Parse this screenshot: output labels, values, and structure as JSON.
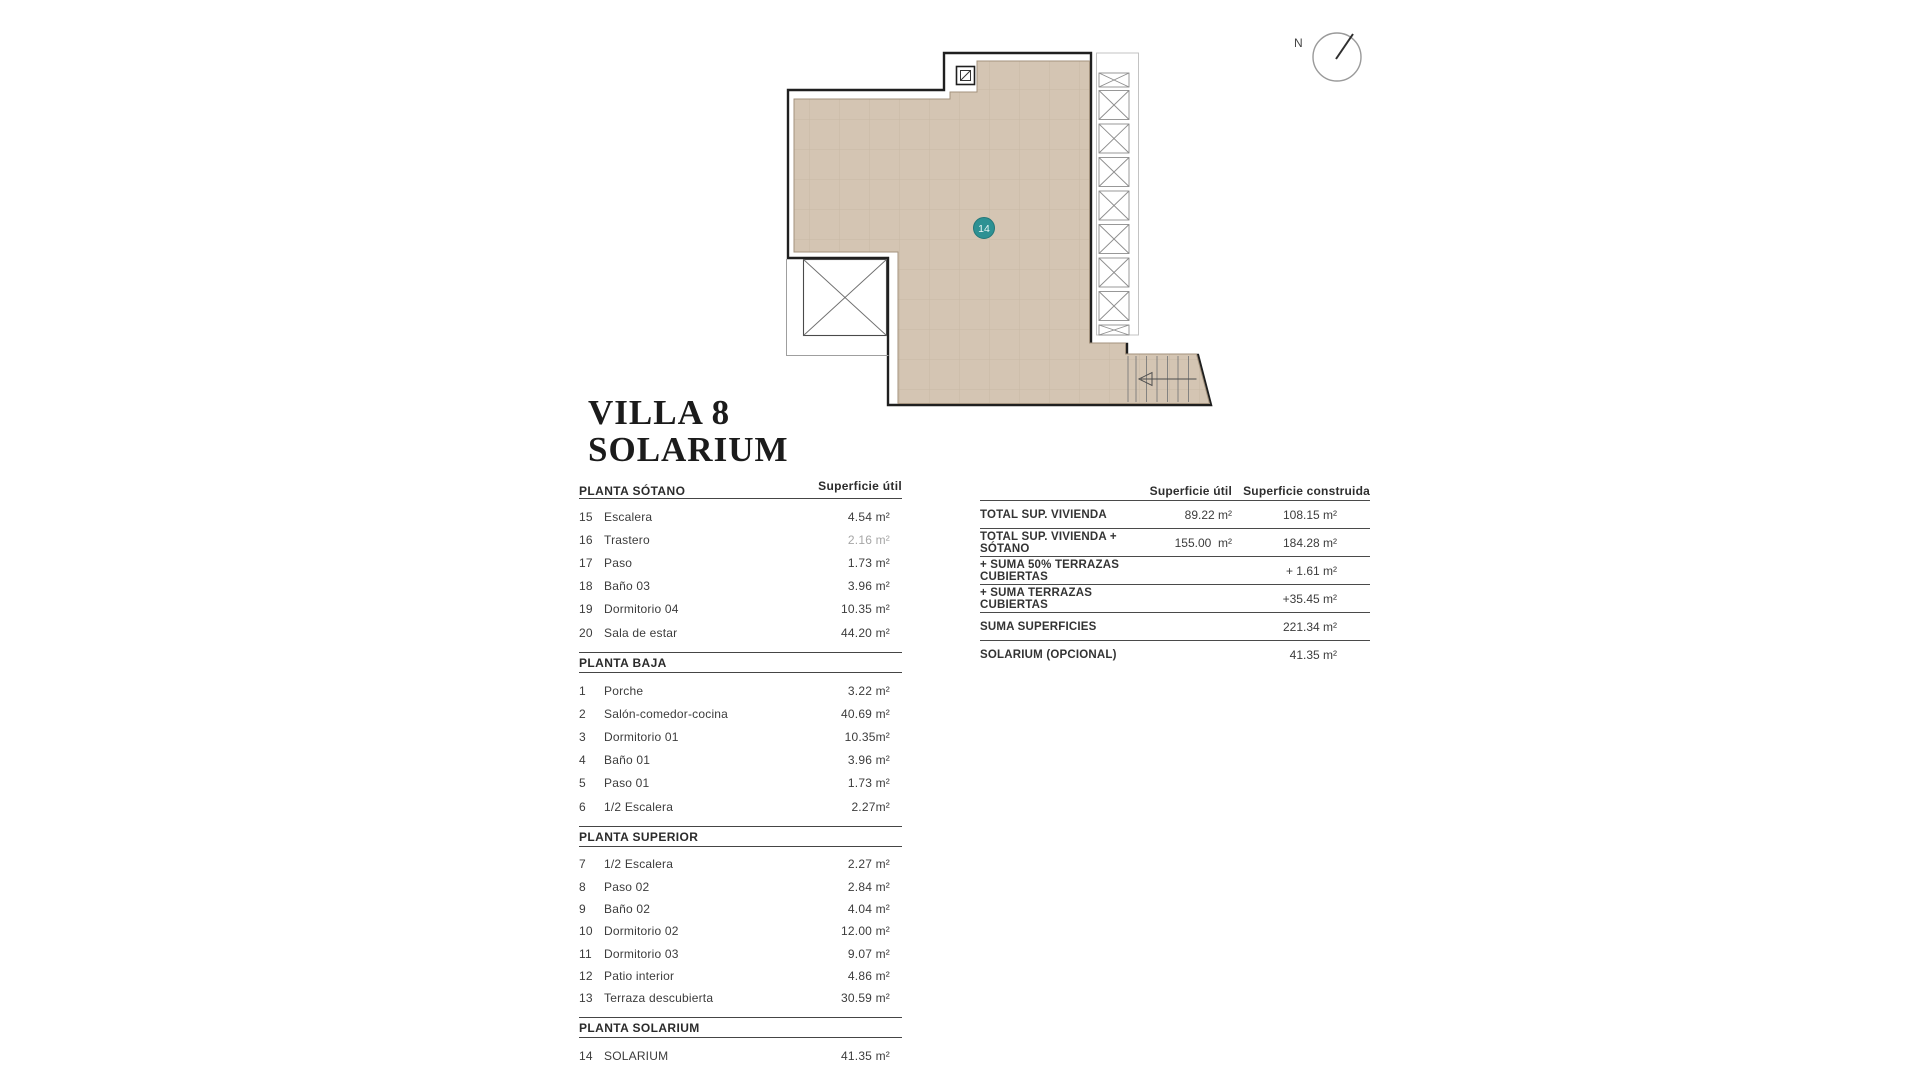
{
  "title": {
    "line1": "VILLA 8",
    "line2": "SOLARIUM"
  },
  "plan": {
    "unit_badge": "14",
    "compass_label": "N"
  },
  "left_table": {
    "area_header": "Superficie útil",
    "sections": [
      {
        "header": "PLANTA SÓTANO",
        "rows": [
          {
            "num": "15",
            "label": "Escalera",
            "value": "4.54 m²"
          },
          {
            "num": "16",
            "label": "Trastero",
            "value": "2.16 m²"
          },
          {
            "num": "17",
            "label": "Paso",
            "value": "1.73 m²"
          },
          {
            "num": "18",
            "label": "Baño 03",
            "value": "3.96 m²"
          },
          {
            "num": "19",
            "label": "Dormitorio 04",
            "value": "10.35 m²"
          },
          {
            "num": "20",
            "label": "Sala de estar",
            "value": "44.20 m²"
          }
        ]
      },
      {
        "header": "PLANTA BAJA",
        "rows": [
          {
            "num": "1",
            "label": "Porche",
            "value": "3.22 m²"
          },
          {
            "num": "2",
            "label": "Salón-comedor-cocina",
            "value": "40.69 m²"
          },
          {
            "num": "3",
            "label": "Dormitorio 01",
            "value": "10.35m²"
          },
          {
            "num": "4",
            "label": "Baño 01",
            "value": "3.96 m²"
          },
          {
            "num": "5",
            "label": "Paso 01",
            "value": "1.73 m²"
          },
          {
            "num": "6",
            "label": "1/2 Escalera",
            "value": "2.27m²"
          }
        ]
      },
      {
        "header": "PLANTA SUPERIOR",
        "rows": [
          {
            "num": "7",
            "label": "1/2 Escalera",
            "value": "2.27 m²"
          },
          {
            "num": "8",
            "label": "Paso 02",
            "value": "2.84 m²"
          },
          {
            "num": "9",
            "label": "Baño 02",
            "value": "4.04 m²"
          },
          {
            "num": "10",
            "label": "Dormitorio 02",
            "value": "12.00 m²"
          },
          {
            "num": "11",
            "label": "Dormitorio 03",
            "value": "9.07 m²"
          },
          {
            "num": "12",
            "label": "Patio interior",
            "value": "4.86 m²"
          },
          {
            "num": "13",
            "label": "Terraza descubierta",
            "value": "30.59 m²"
          }
        ]
      },
      {
        "header": "PLANTA SOLARIUM",
        "rows": [
          {
            "num": "14",
            "label": "SOLARIUM",
            "value": "41.35 m²"
          }
        ]
      }
    ]
  },
  "right_table": {
    "col1": "Superficie útil",
    "col2": "Superficie construida",
    "rows": [
      {
        "label": "TOTAL SUP. VIVIENDA",
        "util": "89.22 m²",
        "construida": "108.15 m²"
      },
      {
        "label": "TOTAL SUP. VIVIENDA + SÓTANO",
        "util": "155.00  m²",
        "construida": "184.28 m²"
      },
      {
        "label": "+ SUMA 50% TERRAZAS CUBIERTAS",
        "util": "",
        "construida": "+ 1.61 m²"
      },
      {
        "label": "+ SUMA TERRAZAS CUBIERTAS",
        "util": "",
        "construida": "+35.45 m²"
      },
      {
        "label": "SUMA SUPERFICIES",
        "util": "",
        "construida": "221.34 m²"
      },
      {
        "label": "SOLARIUM (OPCIONAL)",
        "util": "",
        "construida": "41.35 m²"
      }
    ]
  },
  "colors": {
    "floor_fill": "#d4c5b3",
    "grid_line": "#c8b9a6",
    "outline": "#1f1f1f",
    "badge_teal": "#2d9193",
    "muted_text": "#a6a6a6"
  }
}
